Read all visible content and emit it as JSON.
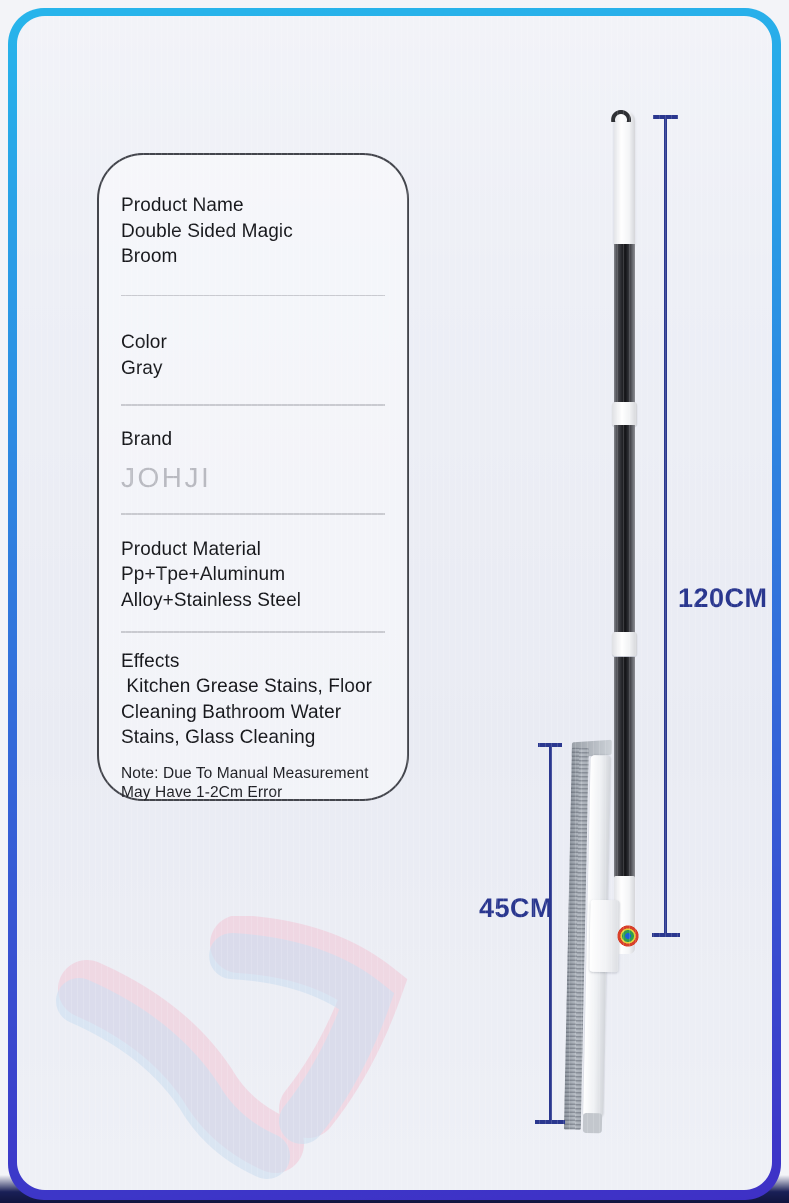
{
  "theme": {
    "frame_top_color": "#27b5eb",
    "frame_bottom_color": "#3e30c6",
    "content_bg": "#edeff6",
    "bottom_edge_color": "#1a2057",
    "measure_color": "#2a378f",
    "card_border_color": "#43454c",
    "text_color": "#17181c",
    "brand_text_color": "#b9bac1",
    "divider_color": "#c9cad0"
  },
  "spec_card": {
    "sections": [
      {
        "label": "Product Name",
        "value": "Double Sided Magic\nBroom"
      },
      {
        "label": "Color",
        "value": "Gray"
      },
      {
        "label": "Brand",
        "value": "JOHJI"
      },
      {
        "label": "Product Material",
        "value": "Pp+Tpe+Aluminum\nAlloy+Stainless Steel"
      },
      {
        "label": "Effects",
        "value": " Kitchen Grease Stains, Floor\nCleaning Bathroom Water\nStains, Glass Cleaning"
      }
    ],
    "note": "Note: Due To Manual Measurement\nMay Have 1-2Cm Error"
  },
  "measurements": {
    "pole_length_label": "120CM",
    "head_width_label": "45CM"
  }
}
